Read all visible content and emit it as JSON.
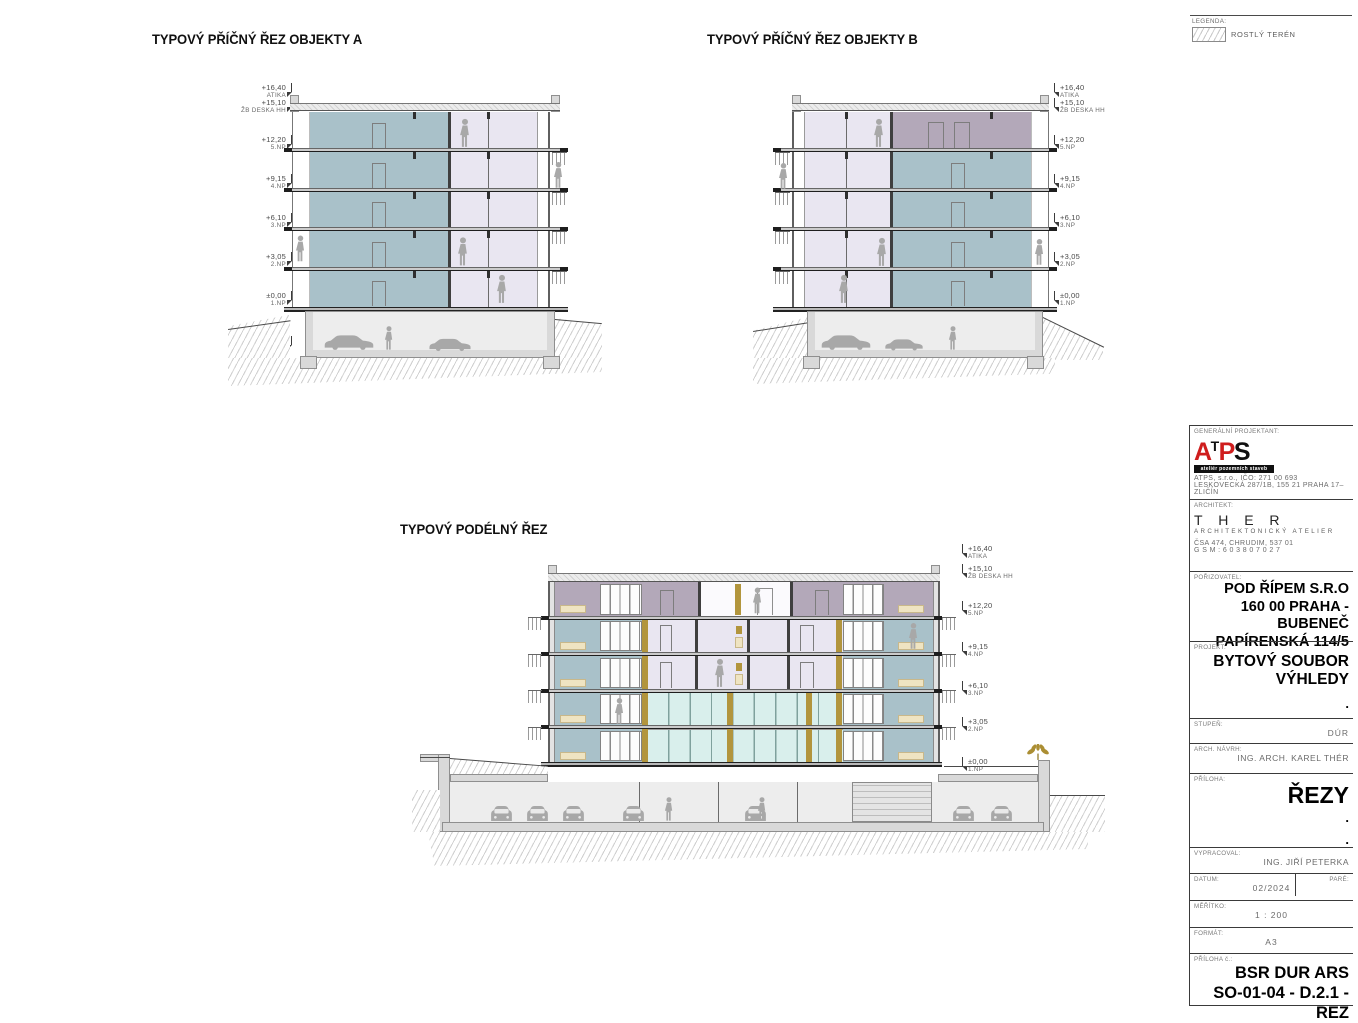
{
  "colors": {
    "wall_blue_gray": "#a9c1c9",
    "wall_lavender": "#e9e6f1",
    "wall_mauve": "#b3a8b9",
    "glass_mint": "#d9efec",
    "wood_gold": "#b2953d",
    "furniture_beige": "#efe4c2",
    "concrete": "#d9d9d9",
    "figure_gray": "#a8a8a8",
    "logo_red": "#cf1d1d"
  },
  "legend": {
    "title": "LEGENDA:",
    "terrain_label": "ROSTLÝ TERÉN"
  },
  "sections": {
    "a": {
      "title": "TYPOVÝ PŘÍČNÝ ŘEZ OBJEKTY A"
    },
    "b": {
      "title": "TYPOVÝ PŘÍČNÝ ŘEZ OBJEKTY B"
    },
    "l": {
      "title": "TYPOVÝ PODÉLNÝ ŘEZ"
    }
  },
  "levels": [
    {
      "elev": "+16,40",
      "name": "ATIKA"
    },
    {
      "elev": "+15,10",
      "name": "ŽB DESKA HH"
    },
    {
      "elev": "+12,20",
      "name": "5.NP"
    },
    {
      "elev": "+9,15",
      "name": "4.NP"
    },
    {
      "elev": "+6,10",
      "name": "3.NP"
    },
    {
      "elev": "+3,05",
      "name": "2.NP"
    },
    {
      "elev": "±0,00",
      "name": "1.NP"
    },
    {
      "elev": "-3,43",
      "name": "1.PP VJEZD"
    }
  ],
  "titleblock": {
    "general_label": "GENERÁLNÍ PROJEKTANT:",
    "logo_a": "A",
    "logo_t": "T",
    "logo_p": "P",
    "logo_s": "S",
    "logo_sub": "ateliér pozemních staveb",
    "company_line1": "ATPS, s.r.o., IČO: 271 00 693",
    "company_line2": "LESKOVECKÁ 287/1B, 155 21 PRAHA 17–ZLIČÍN",
    "architect_label": "ARCHITEKT:",
    "architect_name": "T H E R",
    "architect_sub": "ARCHITEKTONICKÝ ATELIER",
    "architect_addr": "ČSA 474, CHRUDIM, 537 01",
    "architect_gsm": "G S M :  6 0 3  8 0 7  0 2 7",
    "client_label": "POŘIZOVATEL:",
    "client_line1": "POD ŘÍPEM S.R.O",
    "client_line2": "160 00 PRAHA - BUBENEČ",
    "client_line3": "PAPÍRENSKÁ 114/5",
    "project_label": "PROJEKT:",
    "project_line1": "BYTOVÝ SOUBOR",
    "project_line2": "VÝHLEDY",
    "dot": ".",
    "stage_label": "STUPEŇ:",
    "stage_value": "DÚR",
    "arch_design_label": "ARCH. NÁVRH:",
    "arch_design_value": "ING. ARCH. KAREL THÉR",
    "annex_label": "PŘÍLOHA:",
    "annex_value": "ŘEZY",
    "prepared_label": "VYPRACOVAL:",
    "prepared_value": "ING. JIŘÍ PETERKA",
    "date_label": "DATUM:",
    "date_value": "02/2024",
    "pare_label": "PARÉ:",
    "scale_label": "MĚŘÍTKO:",
    "scale_value": "1 : 200",
    "format_label": "FORMÁT:",
    "format_value": "A3",
    "annex_no_label": "PŘÍLOHA č.:",
    "annex_no_line1": "BSR DUR ARS",
    "annex_no_line2": "SO-01-04 - D.2.1 - REZ"
  }
}
